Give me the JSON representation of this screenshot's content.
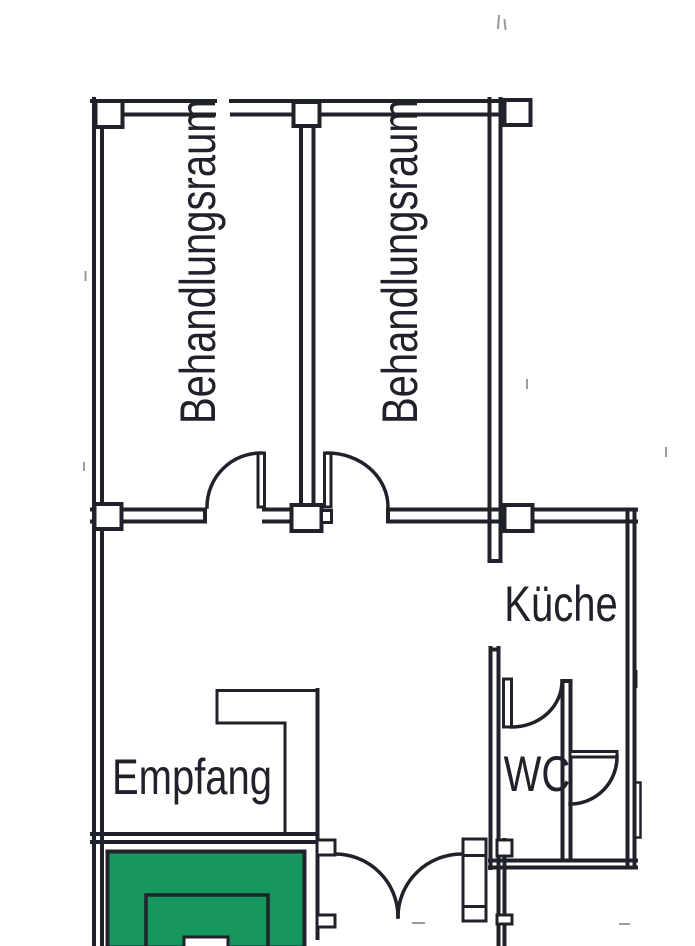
{
  "floor_plan": {
    "rooms": [
      {
        "id": "behandlungsraum-1",
        "label": "Behandlungsraum"
      },
      {
        "id": "behandlungsraum-2",
        "label": "Behandlungsraum"
      },
      {
        "id": "kueche",
        "label": "Küche"
      },
      {
        "id": "empfang",
        "label": "Empfang"
      },
      {
        "id": "wc",
        "label": "WC"
      }
    ],
    "colors": {
      "ink": "#20222b",
      "reception_desk_fill": "#16975e",
      "background": "#ffffff"
    }
  }
}
